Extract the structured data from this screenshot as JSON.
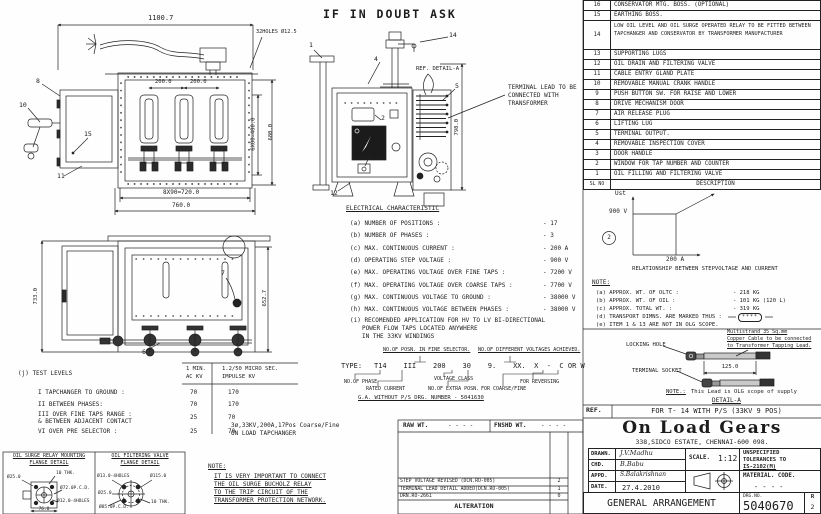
{
  "sheet": {
    "warning": "IF IN DOUBT ASK"
  },
  "parts_list": {
    "header_no": "SL NO",
    "header_desc": "DESCRIPTION",
    "rows": [
      {
        "no": "16",
        "desc": "CONSERVATOR MTG. BOSS. (OPTIONAL)"
      },
      {
        "no": "15",
        "desc": "EARTHING BOSS."
      },
      {
        "no": "14",
        "desc": "LOW OIL LEVEL AND OIL SURGE OPERATED RELAY TO BE FITTED BETWEEN TAPCHANGER AND CONSERVATOR BY TRANSFORMER MANUFACTURER"
      },
      {
        "no": "13",
        "desc": "SUPPORTING LUGS"
      },
      {
        "no": "12",
        "desc": "OIL DRAIN AND FILTERING VALVE"
      },
      {
        "no": "11",
        "desc": "CABLE ENTRY GLAND PLATE"
      },
      {
        "no": "10",
        "desc": "REMOVABLE MANUAL CRANK HANDLE"
      },
      {
        "no": "9",
        "desc": "PUSH BUTTON SW. FOR RAISE AND LOWER"
      },
      {
        "no": "8",
        "desc": "DRIVE MECHANISM DOOR"
      },
      {
        "no": "7",
        "desc": "AIR RELEASE PLUG"
      },
      {
        "no": "6",
        "desc": "LIFTING LUG"
      },
      {
        "no": "5",
        "desc": "TERMINAL OUTPUT."
      },
      {
        "no": "4",
        "desc": "REMOVABLE INSPECTION COVER"
      },
      {
        "no": "3",
        "desc": "DOOR HANDLE"
      },
      {
        "no": "2",
        "desc": "WINDOW FOR TAP NUMBER AND COUNTER"
      },
      {
        "no": "1",
        "desc": "OIL FILLING AND FILTERING VALVE"
      }
    ]
  },
  "graph": {
    "callout": "2",
    "y_label": "Ust",
    "y_tick": "900 V",
    "x_tick": "200 A",
    "caption": "RELATIONSHIP BETWEEN STEPVOLTAGE AND CURRENT"
  },
  "chart_note": "stepvoltage 900 V constant up to 200 A, rising beyond",
  "weight_notes": {
    "heading": "NOTE:",
    "a_label": "(a) APPROX. WT. OF OLTC :",
    "a_value": "- 218 KG",
    "b_label": "(b) APPROX. WT. OF OIL :",
    "b_value": "- 101 KG (120 L)",
    "c_label": "(c) APPROX. TOTAL WT. :",
    "c_value": "- 319 KG",
    "d_label": "(d) TRANSPORT DIMNS. ARE MARKED THUS :",
    "d_value": "****",
    "e_label": "(e) ITEM 1 & 13 ARE NOT IN OLG SCOPE."
  },
  "detail_a": {
    "locking_hole": "LOCKING HOLE",
    "terminal_socket": "TERMINAL SOCKET",
    "cable_note_1": "Multistrand 35 Sq.mm",
    "cable_note_2": "Copper Cable to be connected",
    "cable_note_3": "to Transformer Tapping Lead.",
    "dim": "125.0",
    "lead_note_label": "NOTE.:",
    "lead_note_text": "This Lead is OLG scope of supply",
    "caption": "DETAIL-A"
  },
  "ref_row": {
    "label": "REF.",
    "text": "FOR T- 14 WITH P/S (33KV 9 POS)"
  },
  "title_block": {
    "company": "On Load Gears",
    "address": "338,SIDCO ESTATE, CHENNAI-600 098.",
    "drawn_label": "DRAWN.",
    "drawn": "J.V.Madhu",
    "chd_label": "CHD.",
    "chd": "B.Babu",
    "appd_label": "APPD.",
    "appd": "S.Balakrishnan",
    "date_label": "DATE.",
    "date": "27.4.2010",
    "scale_label": "SCALE.",
    "scale": "1:12",
    "tolerance_1": "UNSPECIFIED",
    "tolerance_2": "TOLERANCES TO",
    "tolerance_3": "IS-2102(M)",
    "material_label": "MATERIAL. CODE.",
    "material_value": "- - - -",
    "doc_title": "GENERAL ARRANGEMENT",
    "drg_no_label": "DRG.NO.",
    "drg_no": "5040670",
    "rev_label": "R",
    "rev": "2"
  },
  "electrical": {
    "heading": "ELECTRICAL CHARACTERISTIC",
    "a_label": "(a) NUMBER OF POSITIONS :",
    "a_value": "- 17",
    "b_label": "(b) NUMBER OF PHASES :",
    "b_value": "- 3",
    "c_label": "(c) MAX. CONTINUOUS CURRENT :",
    "c_value": "- 200 A",
    "d_label": "(d) OPERATING STEP VOLTAGE :",
    "d_value": "- 900 V",
    "e_label": "(e) MAX. OPERATING VOLTAGE OVER FINE TAPS :",
    "e_value": "- 7200 V",
    "f_label": "(f) MAX. OPERATING VOLTAGE OVER COARSE TAPS :",
    "f_value": "- 7700 V",
    "g_label": "(g) MAX. CONTINUOUS VOLTAGE TO GROUND :",
    "g_value": "- 38000 V",
    "h_label": "(h) MAX. CONTINUOUS VOLTAGE BETWEEN PHASES :",
    "h_value": "- 38000 V",
    "i_line1": "(i) RECOMENDED APPLICATION FOR HV TO LV BI-DIRECTIONAL",
    "i_line2": "POWER FLOW TAPS LOCATED ANYWHERE",
    "i_line3": "IN THE 33KV WINDINGS"
  },
  "type_code": {
    "top_label_fine": "NO.OF POSN. IN FINE SELECTOR.",
    "top_label_volt": "NO.OF DIFFERENT VOLTAGES ACHIEVED.",
    "prefix": "TYPE:",
    "code": "T14    III    200    30    9.    XX.  X  -  C OR W",
    "lbl_phase": "NO.OF PHASE",
    "lbl_current": "RATED CURRENT",
    "lbl_voltage": "VOLTAGE CLASS",
    "lbl_extra": "NO.OF EXTRA POSN.",
    "lbl_coarse": "FOR COARSE/FINE",
    "lbl_rev": "FOR REVERSING",
    "ga_note": "G.A. WITHOUT P/S DRG. NUMBER - 5041630"
  },
  "test_levels": {
    "heading": "(j) TEST LEVELS",
    "col1_l1": "1 MIN.",
    "col1_l2": "AC KV",
    "col2_l1": "1.2/50 MICRO SEC.",
    "col2_l2": "IMPULSE KV",
    "r1_label": "I TAPCHANGER TO GROUND :",
    "r1_v1": "70",
    "r1_v2": "170",
    "r2_label": "II BETWEEN PHASES:",
    "r2_v1": "70",
    "r2_v2": "170",
    "r3_label_1": "III OVER FINE TAPS RANGE :",
    "r3_label_2": "& BETWEEN ADJACENT CONTACT",
    "r3_v1": "25",
    "r3_v2": "70",
    "r4_label": "VI OVER PRE SELECTOR :",
    "r4_v1": "25",
    "r4_v2": "70"
  },
  "oltc_label": {
    "line1": "3ø,33KV,200A,17Pos Coarse/Fine",
    "line2": "ON LOAD TAPCHANGER"
  },
  "protection_note": {
    "heading": "NOTE:",
    "line1": "IT IS VERY IMPORTANT TO CONNECT",
    "line2": "THE OIL SURGE BUCHOLZ RELAY",
    "line3": "TO THE TRIP CIRCUIT OF THE",
    "line4": "TRANSFORMER PROTECTION NETWORK."
  },
  "flange_surge": {
    "title_1": "OIL SURGE RELAY MOUNTING",
    "title_2": "FLANGE DETAIL",
    "d25": "Ø25.0",
    "thk": "10 THK.",
    "pcd": "Ø72.0P.C.D.",
    "holes": "Ø12.0-4HOLES",
    "d76": "76.0"
  },
  "flange_filter": {
    "title_1": "OIL FILTERING VALVE",
    "title_2": "FLANGE DETAIL",
    "holes": "Ø13.0-4HOLES",
    "d115": "Ø115.0",
    "d25": "Ø25.0",
    "pcd": "Ø85.0P.C.D.",
    "thk": "10 THK."
  },
  "alteration": {
    "raw_label": "RAW WT.",
    "raw_value": "- - - -",
    "fnshd_label": "FNSHD WT.",
    "fnshd_value": "- - - -",
    "rows": [
      {
        "desc": "STEP VOLTAGE REVISED (DCN.RO-005)",
        "rev": "2"
      },
      {
        "desc": "TERMINAL LEAD DETAIL ADDED(DCN.RO-005)",
        "rev": "1"
      },
      {
        "desc": "DRN.RO-2661",
        "rev": "0"
      }
    ],
    "footer": "ALTERATION"
  },
  "front_view": {
    "dim_width": "1100.7",
    "holes": "32HOLES Ø12.5",
    "dim_200a": "200.0",
    "dim_200b": "200.0",
    "dim_480": "6X80=480.0",
    "dim_680": "680.0",
    "dim_720": "8X90=720.0",
    "dim_760": "760.0",
    "c8": "8",
    "c10": "10",
    "c15": "15",
    "c11": "11"
  },
  "side_view": {
    "dim_733": "733.0",
    "dim_652": "652.7",
    "c7": "7",
    "c6": "6"
  },
  "mech_view": {
    "c14": "14",
    "c4": "4",
    "c5": "5",
    "c2": "2",
    "c3": "3",
    "c12": "12",
    "c1": "1",
    "ref_detail": "REF. DETAIL-A",
    "terminal_note_1": "TERMINAL LEAD TO BE",
    "terminal_note_2": "CONNECTED WITH",
    "terminal_note_3": "TRANSFORMER",
    "dim_798": "798.0"
  }
}
